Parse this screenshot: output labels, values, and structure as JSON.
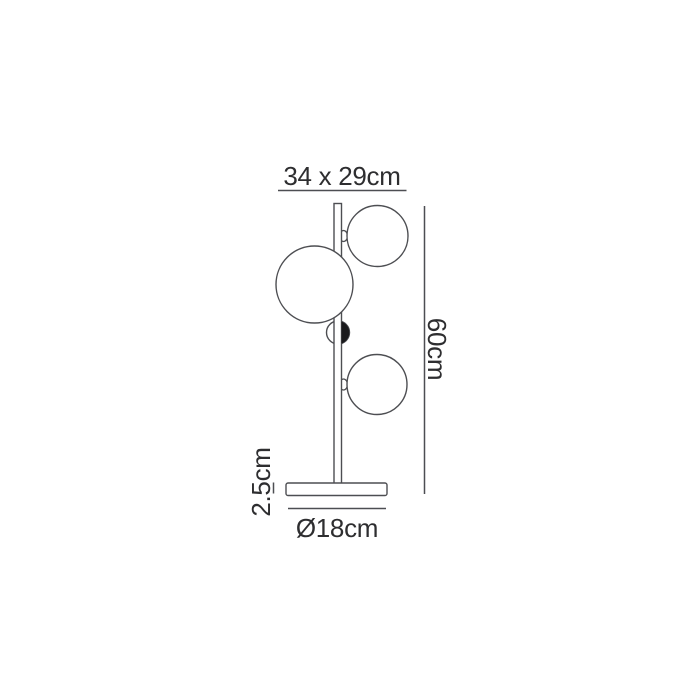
{
  "diagram": {
    "name": "table-lamp-dimension-drawing",
    "colors": {
      "background": "#ffffff",
      "line": "#4d4e52",
      "text": "#2e2e30",
      "shape_fill": "#ffffff",
      "dark_detail": "#1a1a1c"
    },
    "labels": {
      "shade_dimensions": "34 x 29cm",
      "total_height": "60cm",
      "base_thickness": "2.5cm",
      "base_diameter": "Ø18cm"
    }
  }
}
